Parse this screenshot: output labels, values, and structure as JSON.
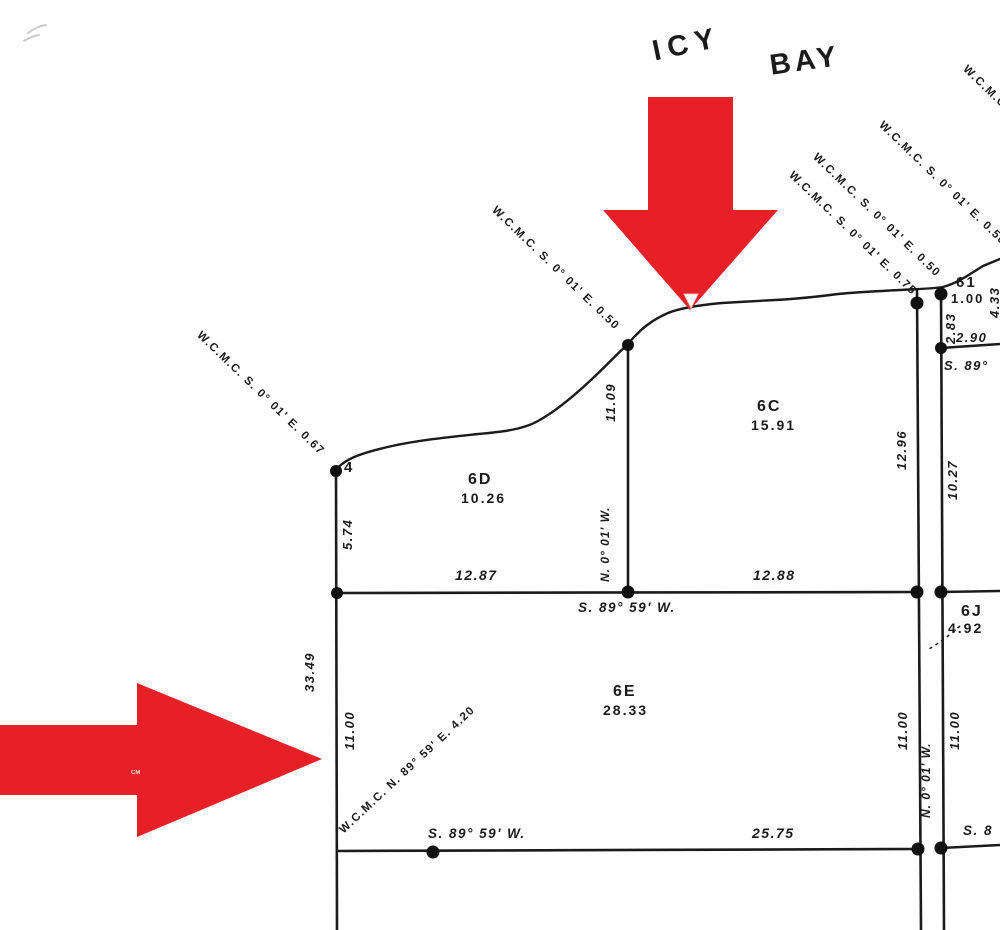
{
  "colors": {
    "arrow_red": "#e71f26",
    "ink": "#1b1b1b"
  },
  "title": {
    "icy": "ICY",
    "bay": "BAY"
  },
  "lots": {
    "c": {
      "id": "6C",
      "area": "15.91"
    },
    "d": {
      "id": "6D",
      "area": "10.26"
    },
    "e": {
      "id": "6E",
      "area": "28.33"
    },
    "j": {
      "id": "6J",
      "area": "4.92"
    },
    "i": {
      "id": "61",
      "area": "1.00"
    }
  },
  "meander": {
    "m067": "W.C.M.C. S. 0° 01' E. 0.67",
    "m050a": "W.C.M.C. S. 0° 01' E. 0.50",
    "m050b": "W.C.M.C. S. 0° 01' E. 0.50",
    "m075": "W.C.M.C. S. 0° 01' E. 0.75",
    "m050c": "W.C.M.C. S. 0° 01' E. 0.50",
    "mcut": "W.C.M.C.",
    "m420": "W.C.M.C. N. 89° 59' E. 4.20"
  },
  "bearings": {
    "s8959w": "S. 89° 59' W.",
    "n001w": "N. 0° 01' W.",
    "s89": "S. 89°",
    "s8": "S. 8"
  },
  "dims": {
    "d1109": "11.09",
    "d1296": "12.96",
    "d1027": "10.27",
    "d574": "5.74",
    "d3349": "33.49",
    "d1100": "11.00",
    "d1287": "12.87",
    "d1288": "12.88",
    "d2575": "25.75",
    "d283": "2.83",
    "d290": "2.90",
    "d433": "4.33"
  },
  "corner": {
    "four": "4"
  },
  "watermark": "CM"
}
